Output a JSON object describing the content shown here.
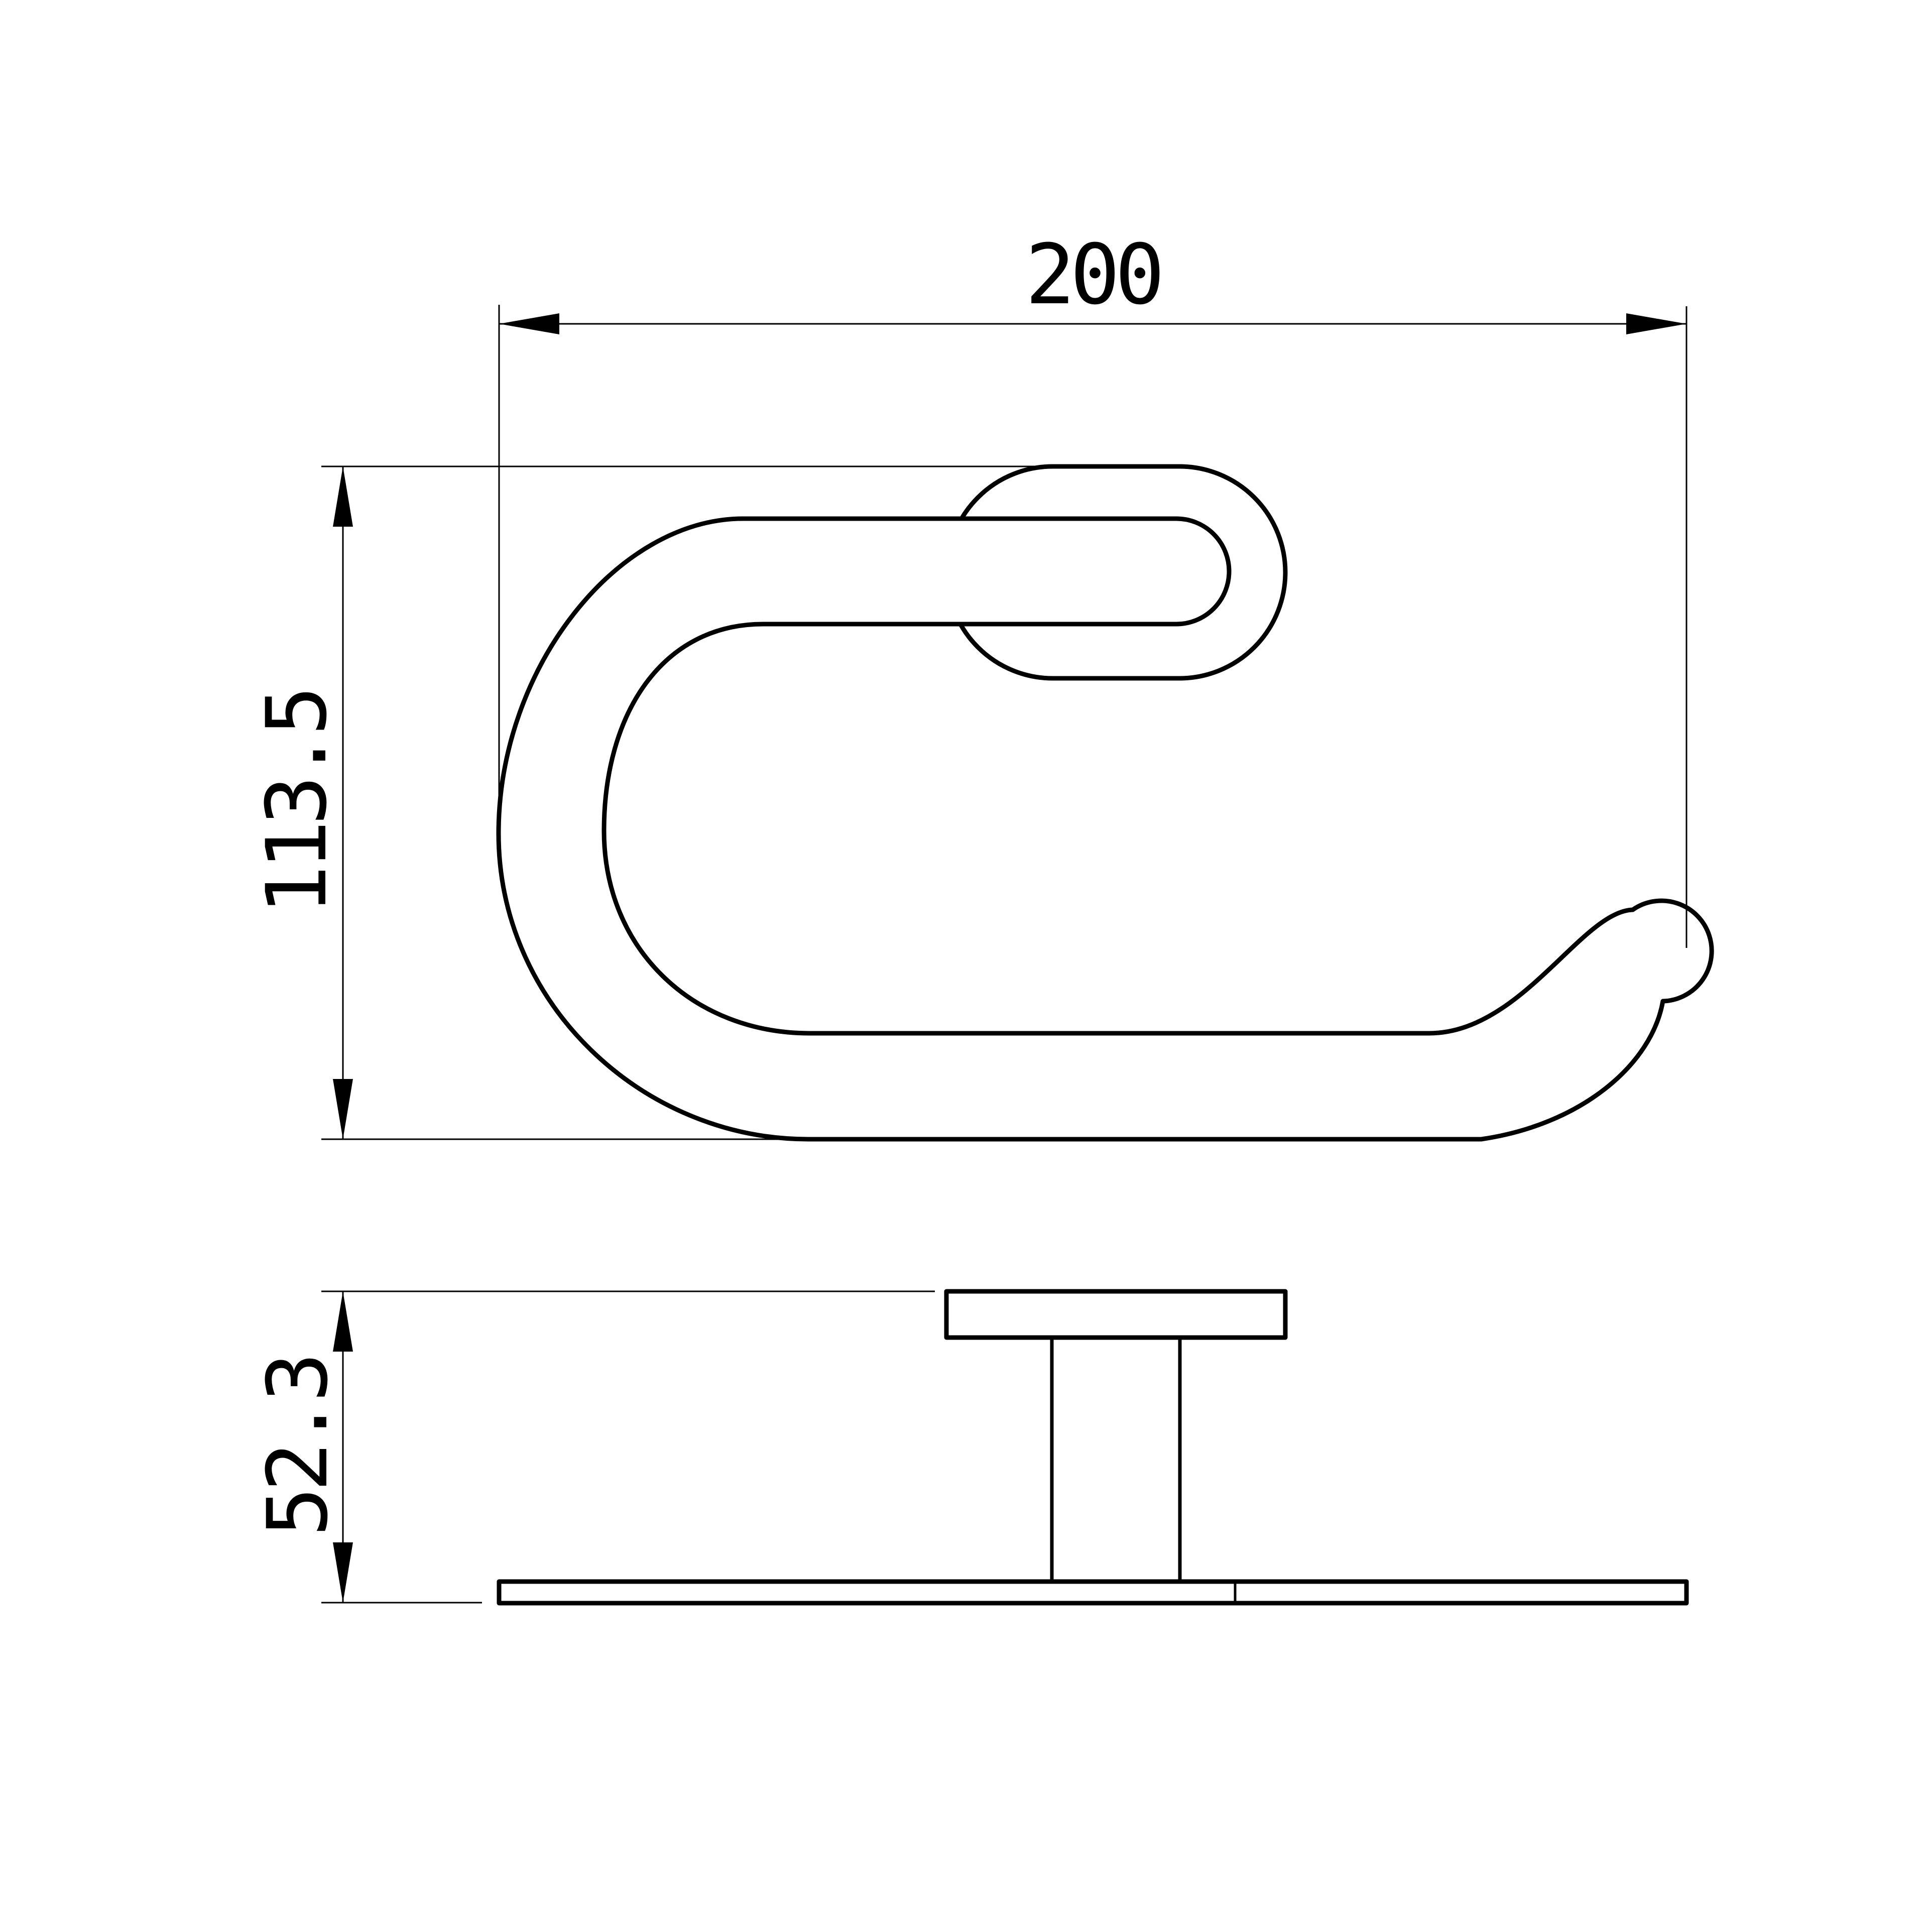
{
  "drawing": {
    "type": "technical-drawing",
    "colors": {
      "background": "#ffffff",
      "line": "#000000"
    },
    "dimensions": {
      "width": {
        "label": "200"
      },
      "height": {
        "label": "113.5"
      },
      "depth": {
        "label": "52.3"
      }
    }
  }
}
